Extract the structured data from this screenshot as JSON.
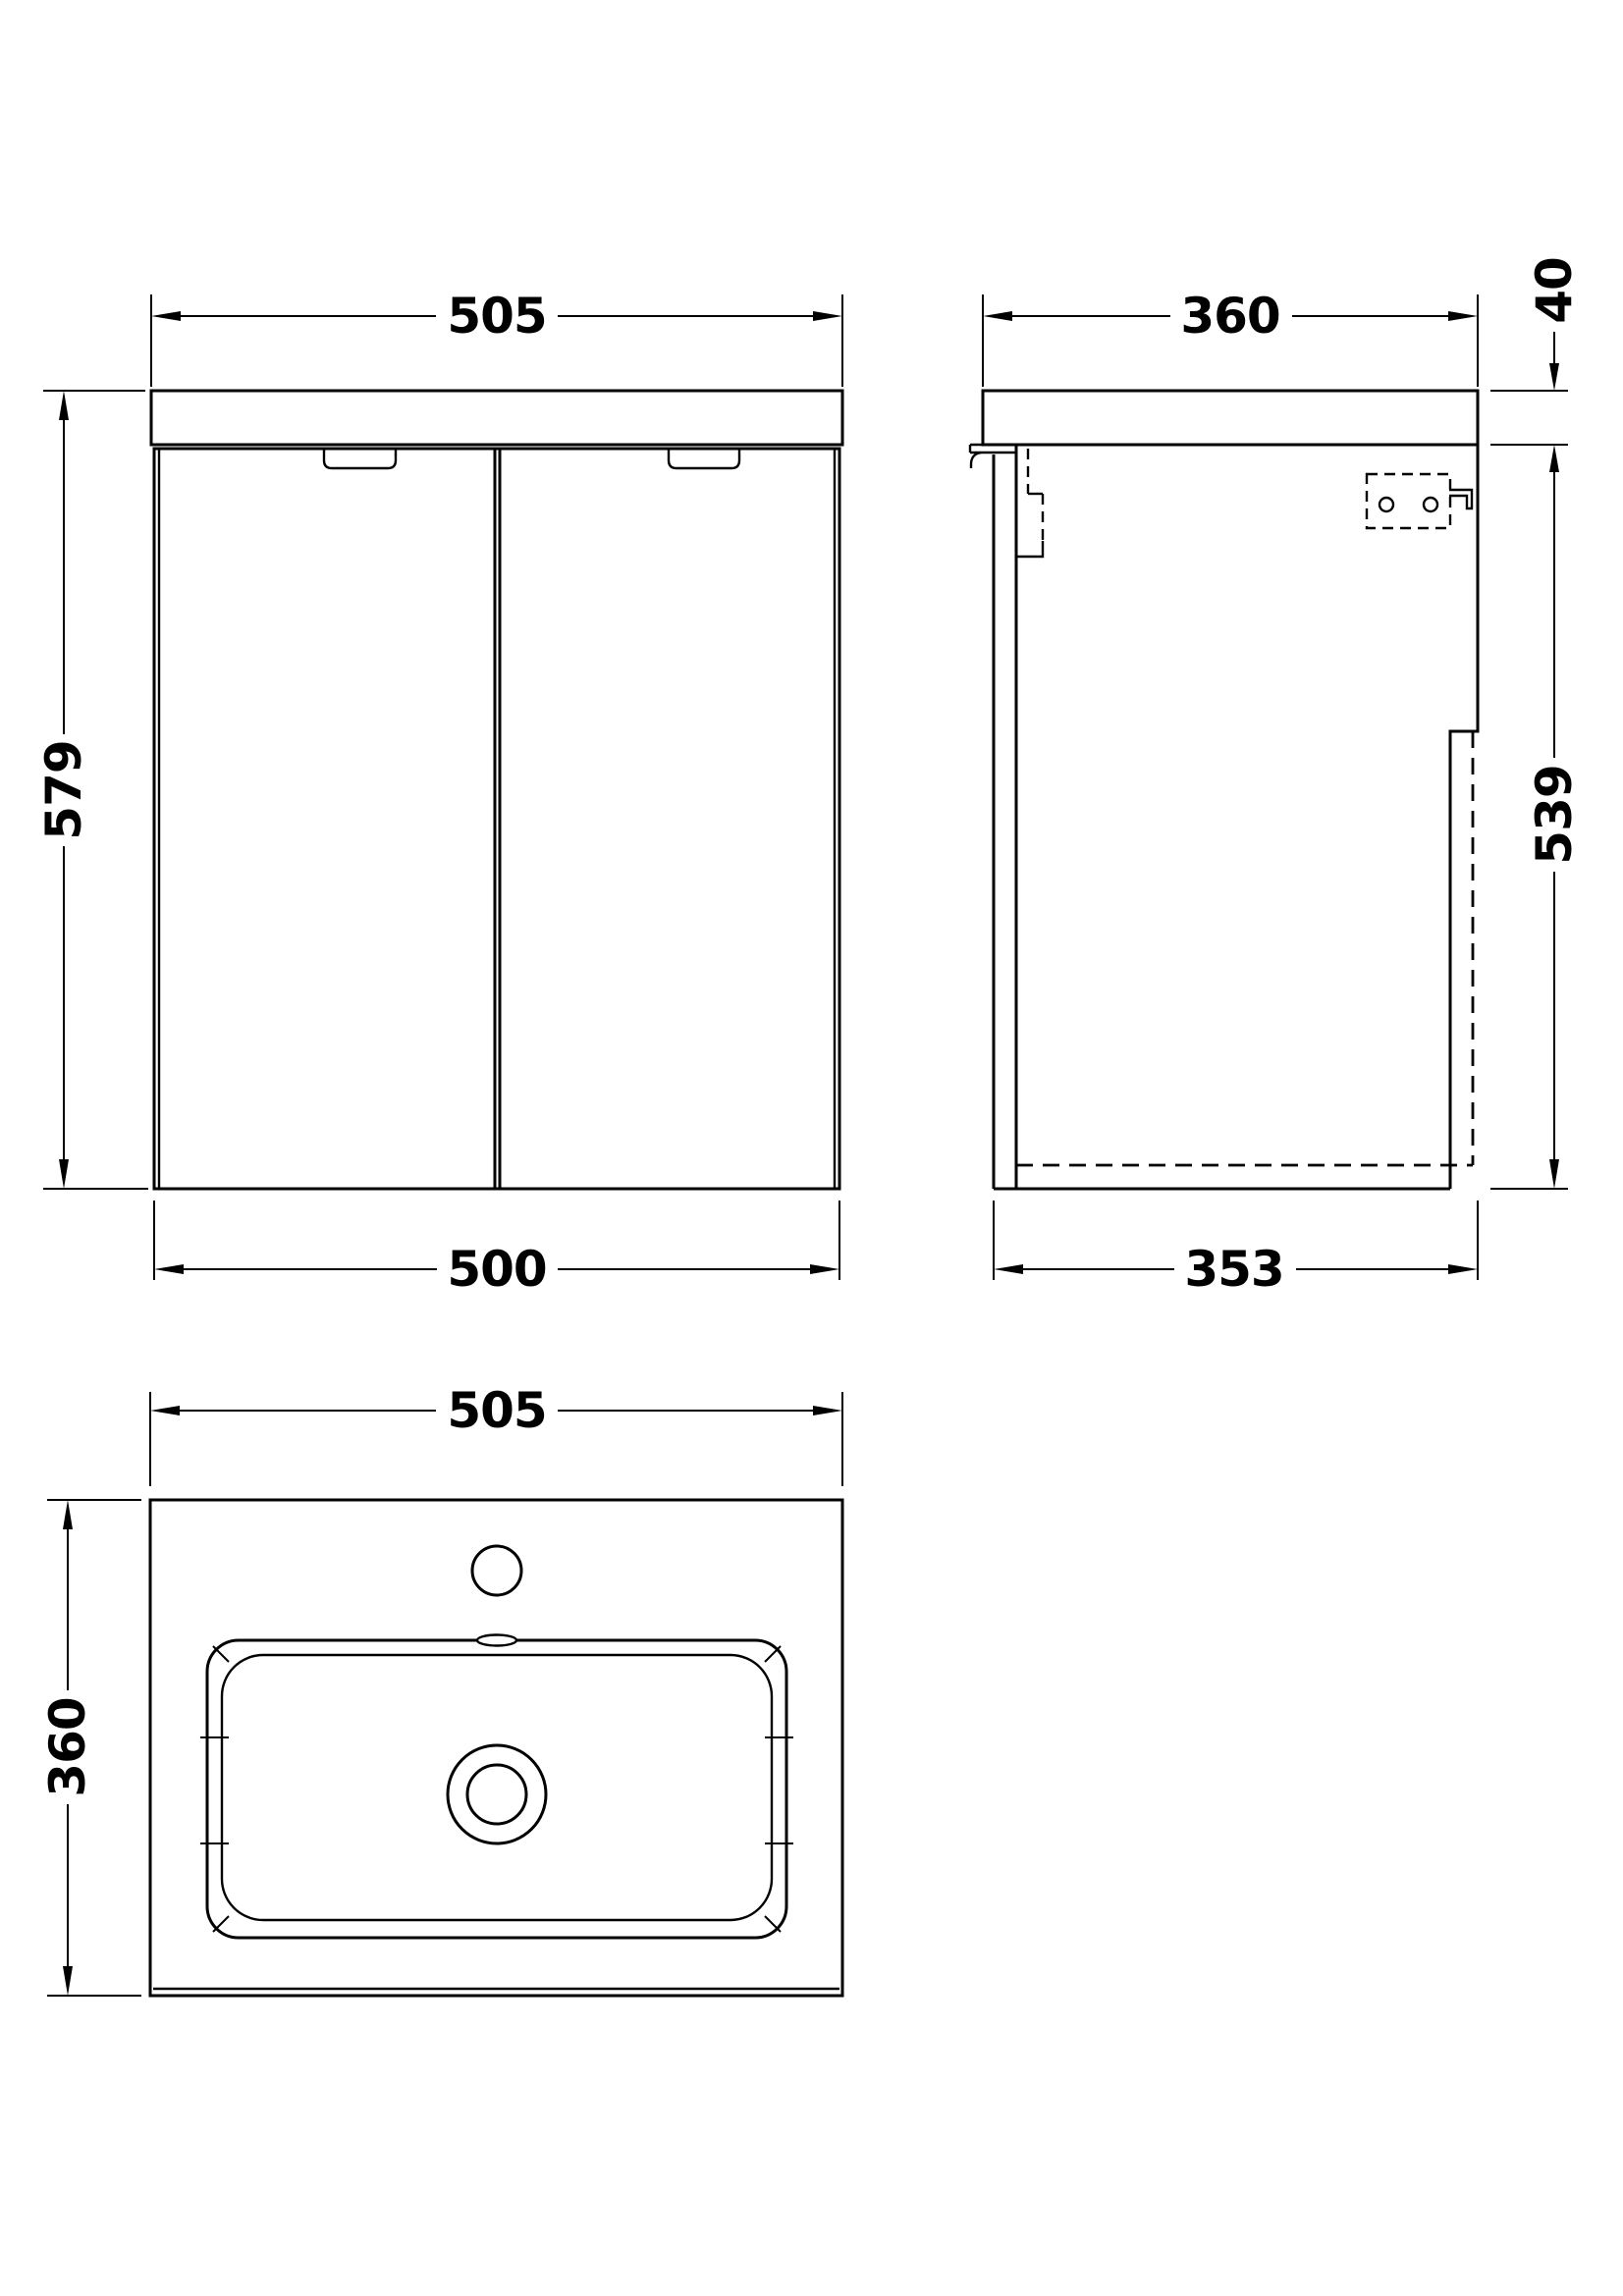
{
  "drawing": {
    "type": "technical-dimension-drawing",
    "subject": "wall-hung vanity unit with basin",
    "line_color": "#000000",
    "background_color": "#ffffff",
    "front_view": {
      "width_top": "505",
      "height_overall": "579",
      "width_cabinet": "500"
    },
    "side_view": {
      "depth_top": "360",
      "worktop_thickness": "40",
      "cabinet_height": "539",
      "cabinet_depth": "353"
    },
    "plan_view": {
      "width": "505",
      "depth": "360"
    }
  }
}
